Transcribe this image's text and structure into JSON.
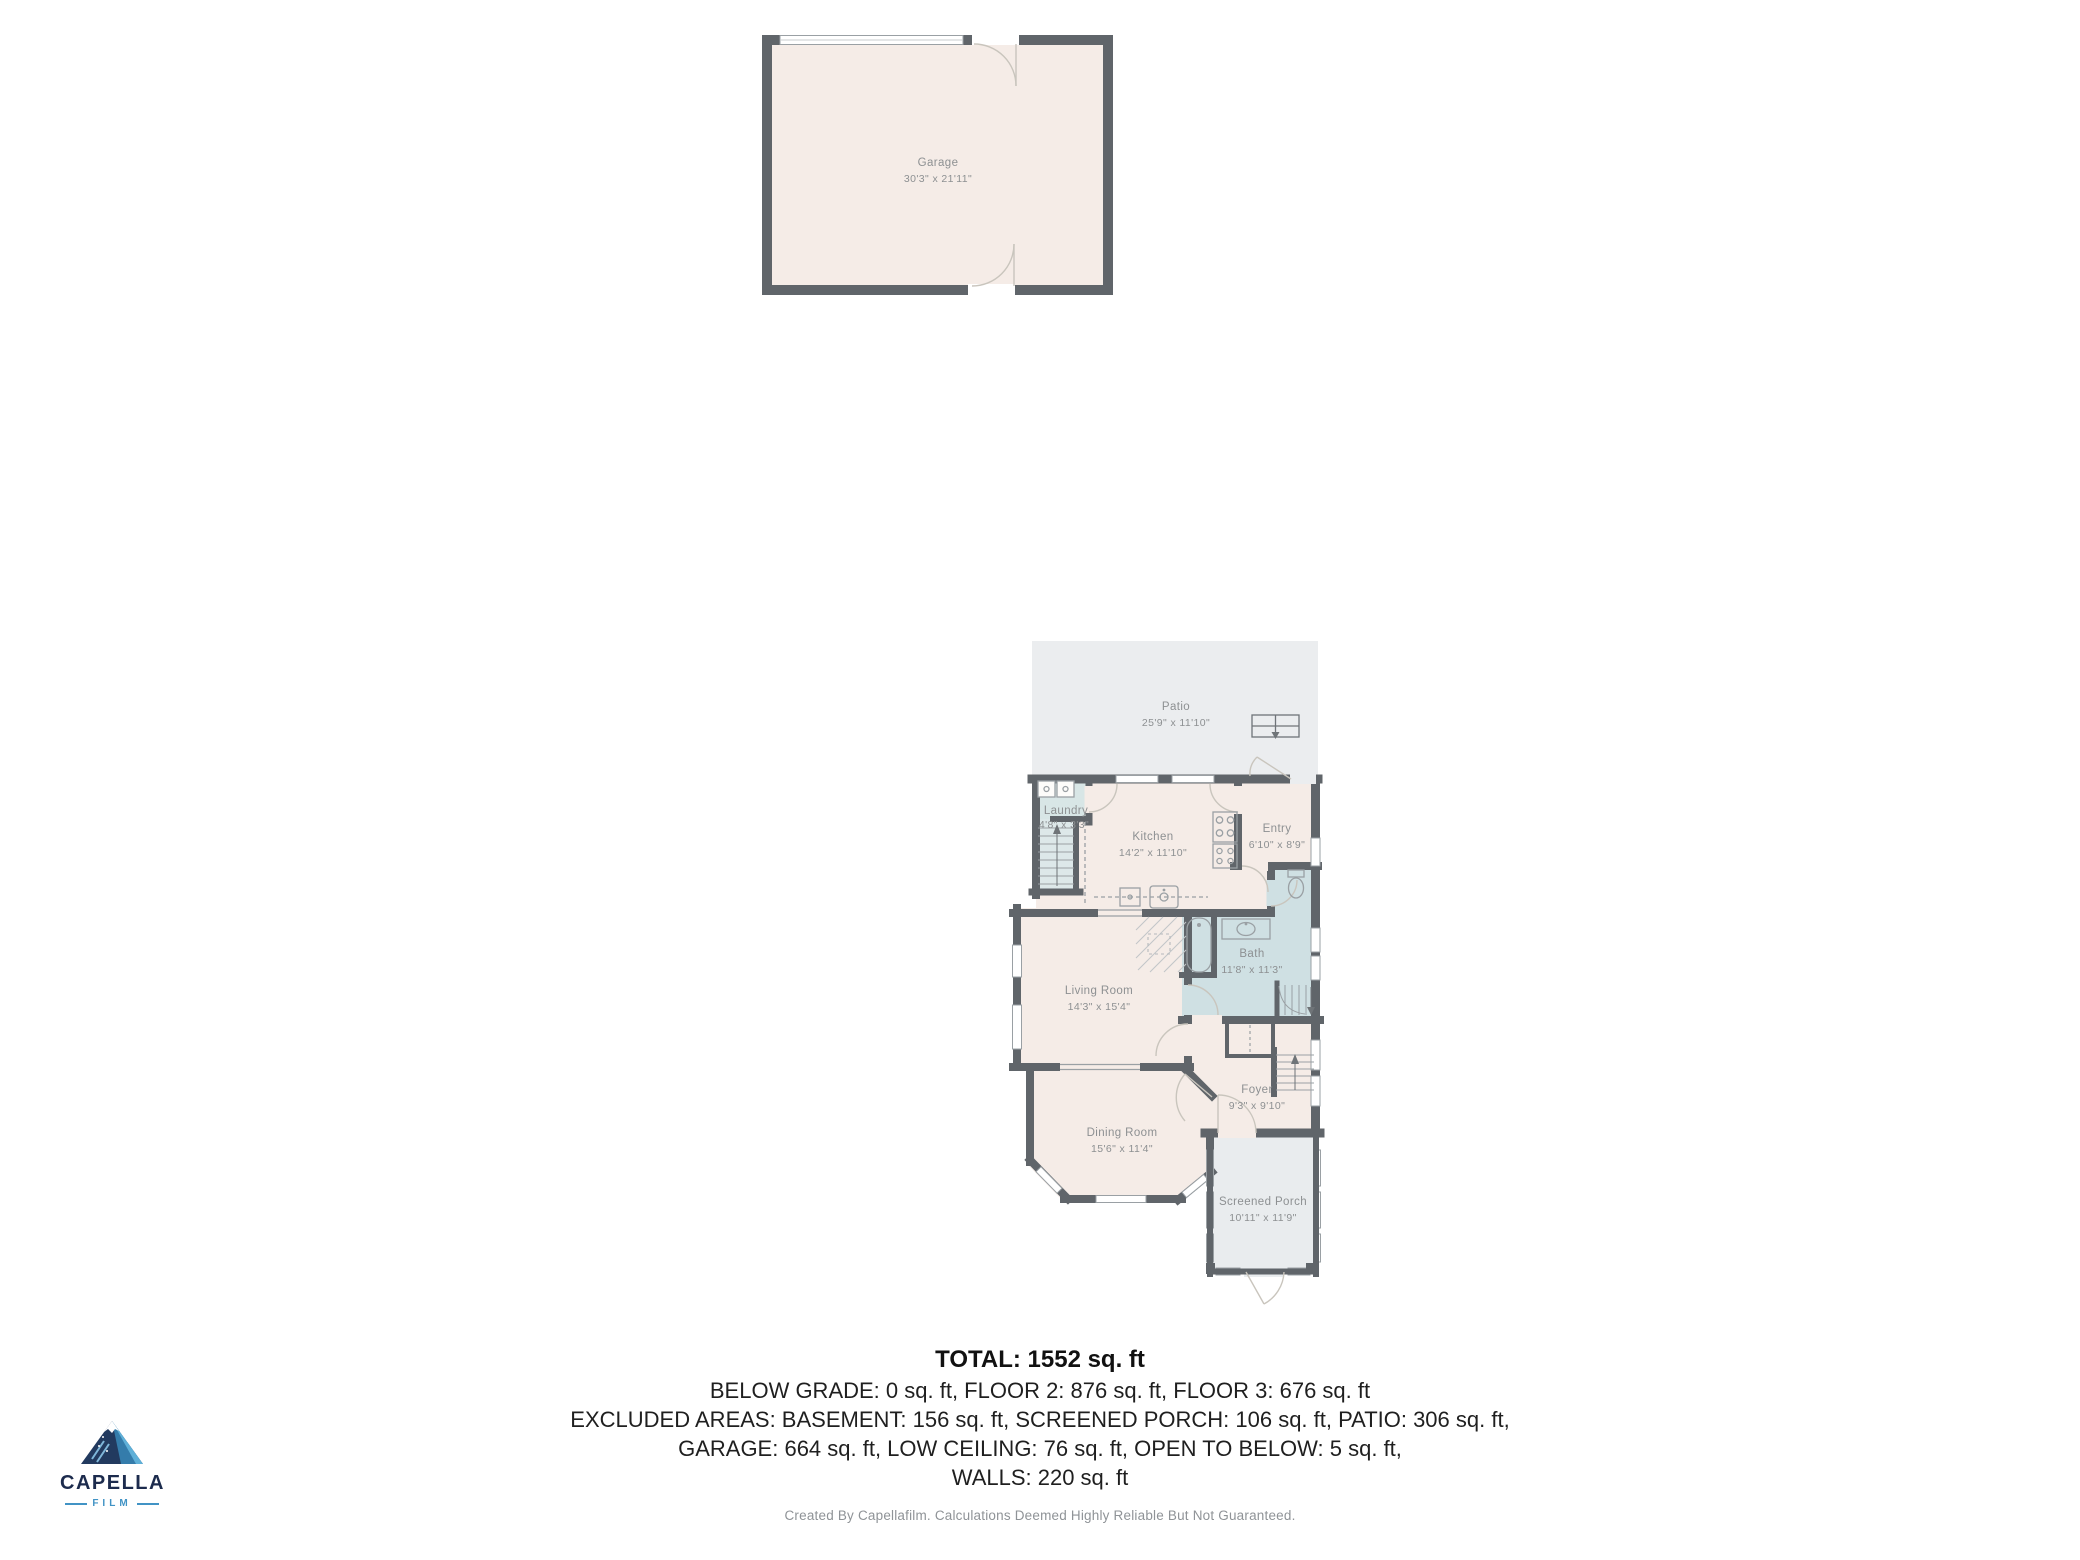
{
  "garage": {
    "name": "Garage",
    "dims": "30'3\" x 21'11\""
  },
  "rooms": {
    "patio": {
      "name": "Patio",
      "dims": "25'9\" x 11'10\""
    },
    "laundry": {
      "name": "Laundry",
      "dims": "4'8\" x 3'3\""
    },
    "kitchen": {
      "name": "Kitchen",
      "dims": "14'2\" x 11'10\""
    },
    "entry": {
      "name": "Entry",
      "dims": "6'10\" x 8'9\""
    },
    "bath": {
      "name": "Bath",
      "dims": "11'8\" x 11'3\""
    },
    "living_room": {
      "name": "Living Room",
      "dims": "14'3\" x 15'4\""
    },
    "foyer": {
      "name": "Foyer",
      "dims": "9'3\" x 9'10\""
    },
    "dining_room": {
      "name": "Dining Room",
      "dims": "15'6\" x 11'4\""
    },
    "screened_porch": {
      "name": "Screened Porch",
      "dims": "10'11\" x 11'9\""
    }
  },
  "summary": {
    "total": "TOTAL: 1552 sq. ft",
    "line2": "BELOW GRADE: 0 sq. ft, FLOOR 2: 876 sq. ft, FLOOR 3: 676 sq. ft",
    "line3": "EXCLUDED AREAS: BASEMENT: 156 sq. ft, SCREENED PORCH: 106 sq. ft, PATIO: 306 sq. ft,",
    "line4": "GARAGE: 664 sq. ft, LOW CEILING: 76 sq. ft, OPEN TO BELOW: 5 sq. ft,",
    "line5": "WALLS: 220 sq. ft"
  },
  "footer": {
    "disclaimer": "Created By Capellafilm. Calculations Deemed Highly Reliable But Not Guaranteed."
  },
  "logo": {
    "brand": "CAPELLA",
    "sub": "FILM"
  },
  "colors": {
    "wall": "#60656a",
    "room_fill": "#f5ece7",
    "patio_fill": "#ebedef",
    "bath_fill": "#cfe0e3",
    "laundry_fill": "#d8e6e6",
    "stair_fill": "#dde8e9",
    "label_text": "#8d9092",
    "summary_text": "#1f1f1f",
    "footer_text": "#8f9397",
    "logo_navy": "#1c2b4d",
    "logo_blue": "#4193c5"
  }
}
